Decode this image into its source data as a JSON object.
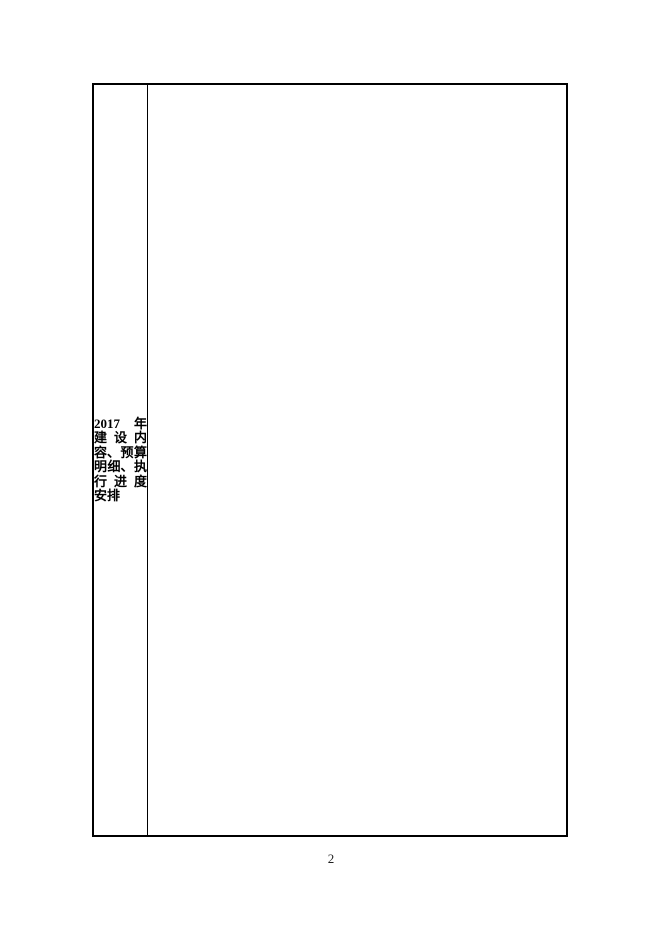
{
  "page": {
    "number": "2"
  },
  "table": {
    "label_cell": {
      "text": "2017 年建设内容、预算明细、执行进度安排",
      "lines": [
        {
          "segments": [
            "2017",
            "年"
          ]
        },
        {
          "segments": [
            "建",
            "设",
            "内"
          ]
        },
        {
          "segments": [
            "容、",
            "预",
            "算"
          ]
        },
        {
          "segments": [
            "明",
            "细、",
            "执"
          ]
        },
        {
          "segments": [
            "行",
            "进",
            "度"
          ]
        },
        {
          "segments": [
            "安排"
          ]
        }
      ]
    },
    "content_cell": {
      "text": ""
    }
  },
  "colors": {
    "background": "#ffffff",
    "border": "#000000",
    "text": "#000000",
    "page_number": "#1f1f1f"
  }
}
